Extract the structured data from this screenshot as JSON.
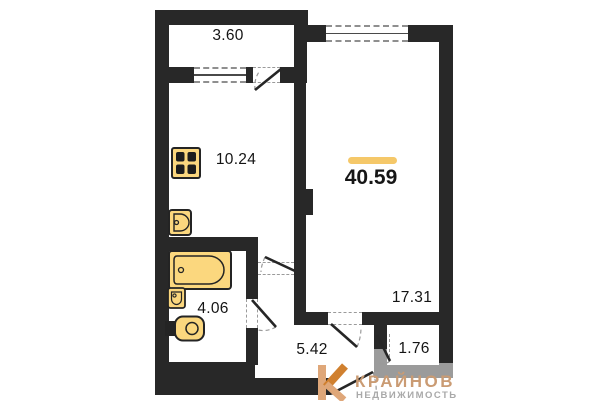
{
  "plan": {
    "total": {
      "area": "40.59"
    },
    "rooms": [
      {
        "name": "balcony",
        "area": "3.60"
      },
      {
        "name": "kitchen",
        "area": "10.24"
      },
      {
        "name": "living-room",
        "area": "17.31"
      },
      {
        "name": "bathroom",
        "area": "4.06"
      },
      {
        "name": "hallway",
        "area": "5.42"
      },
      {
        "name": "storage",
        "area": "1.76"
      }
    ],
    "fixtures": [
      "stove-icon",
      "kitchen-sink-icon",
      "bathtub-icon",
      "washbasin-icon",
      "toilet-icon"
    ]
  },
  "branding": {
    "name": "КРАЙНОВ",
    "tagline": "НЕДВИЖИМОСТЬ",
    "logo": "brand-logo-icon"
  },
  "colors": {
    "wall": "#282828",
    "wall_light": "#9b9b9b",
    "fixture_fill": "#FBD77E",
    "accent_bar": "#F5C869",
    "brand_text": "#CA9B73",
    "tagline_text": "#A9A9A9"
  }
}
